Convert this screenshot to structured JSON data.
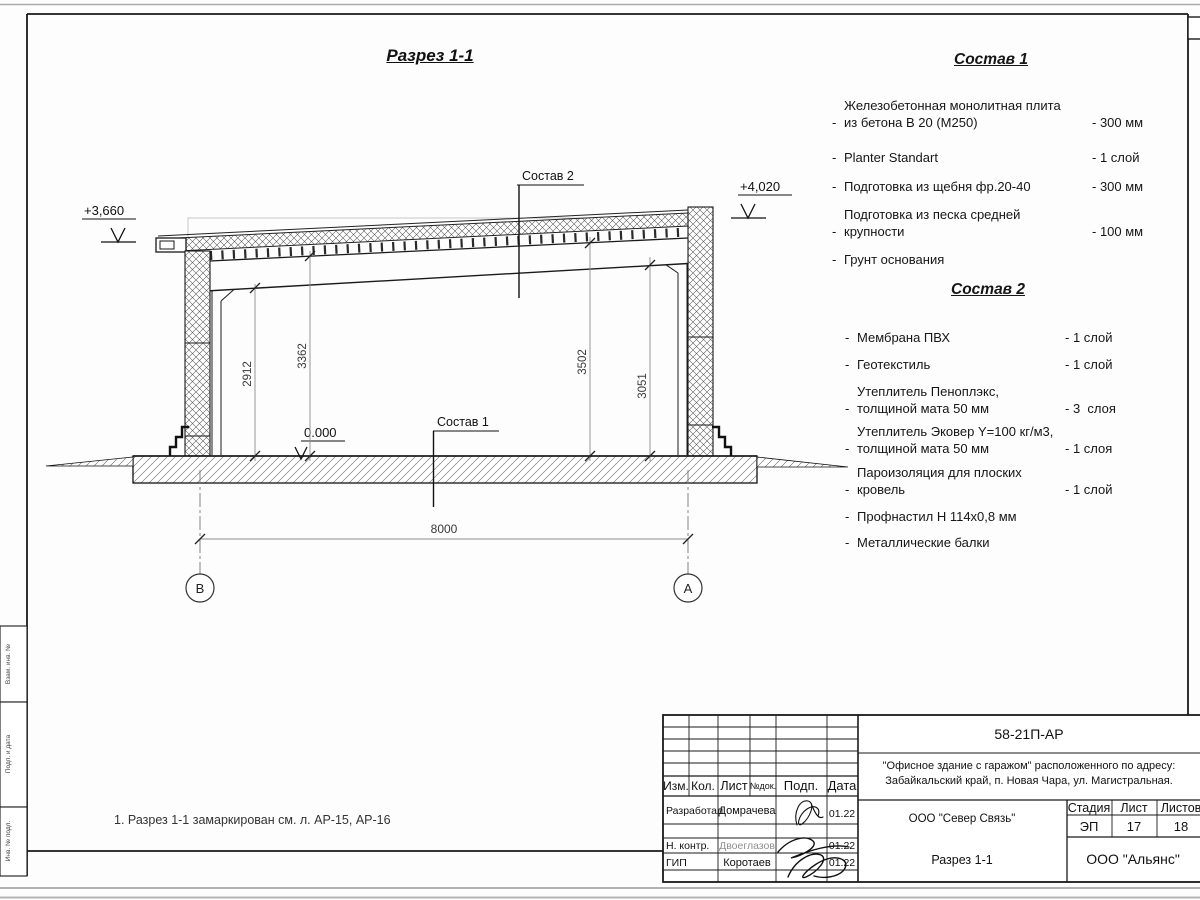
{
  "drawing": {
    "title": "Разрез 1-1",
    "note": "1. Разрез 1-1 замаркирован см. л. АР-15, АР-16",
    "elev_left": "+3,660",
    "elev_right": "+4,020",
    "elev_zero": "0.000",
    "dim_left_inner": "2912",
    "dim_left_outer": "3362",
    "dim_right_outer": "3502",
    "dim_right_inner": "3051",
    "dim_span": "8000",
    "axis_left": "В",
    "axis_right": "А",
    "label_sostav1": "Состав 1",
    "label_sostav2": "Состав 2"
  },
  "sostav1": {
    "heading": "Состав 1",
    "bullet": "-",
    "items": [
      {
        "name": "Железобетонная  монолитная плита\nиз бетона В 20 (М250)",
        "value": "- 300 мм"
      },
      {
        "name": "Planter Standart",
        "value": "- 1 слой"
      },
      {
        "name": "Подготовка из щебня фр.20-40",
        "value": "- 300 мм"
      },
      {
        "name": "Подготовка из песка средней\nкрупности",
        "value": "- 100 мм"
      },
      {
        "name": "Грунт основания",
        "value": ""
      }
    ]
  },
  "sostav2": {
    "heading": "Состав 2",
    "bullet": "-",
    "items": [
      {
        "name": "Мембрана ПВХ",
        "value": "- 1 слой"
      },
      {
        "name": "Геотекстиль",
        "value": "- 1 слой"
      },
      {
        "name": "Утеплитель Пеноплэкс,\nтолщиной мата 50 мм",
        "value": "- 3  слоя"
      },
      {
        "name": "Утеплитель Эковер Y=100 кг/м3,\nтолщиной мата 50 мм",
        "value": "- 1 слоя"
      },
      {
        "name": "Пароизоляция для плоских кровель",
        "value": "- 1 слой"
      },
      {
        "name": "Профнастил Н 114х0,8 мм",
        "value": ""
      },
      {
        "name": "Металлические балки",
        "value": ""
      }
    ]
  },
  "titleblock": {
    "code": "58-21П-АР",
    "project_line1": "\"Офисное здание с гаражом\" расположенного по адресу:",
    "project_line2": "Забайкальский край, п. Новая Чара, ул. Магистральная.",
    "designer_org": "ООО \"Север Связь\"",
    "doc_title": "Разрез 1-1",
    "client_org": "ООО \"Альянс\"",
    "stage_label": "Стадия",
    "sheet_label": "Лист",
    "sheets_label": "Листов",
    "stage": "ЭП",
    "sheet_no": "17",
    "sheets_total": "18",
    "col_izm": "Изм.",
    "col_kol": "Кол.",
    "col_list": "Лист",
    "col_ndok": "№док.",
    "col_podp": "Подп.",
    "col_data": "Дата",
    "r1_role": "Разработал",
    "r1_name": "Домрачева",
    "r1_date": "01.22",
    "r2_role": "Н. контр.",
    "r2_name": "Двоеглазов",
    "r2_date": "01.22",
    "r3_role": "ГИП",
    "r3_name": "Коротаев",
    "r3_date": "01.22"
  },
  "binding": {
    "labels": [
      "Взам. инв. №",
      "Подп. и дата",
      "Инв. № подл."
    ]
  }
}
